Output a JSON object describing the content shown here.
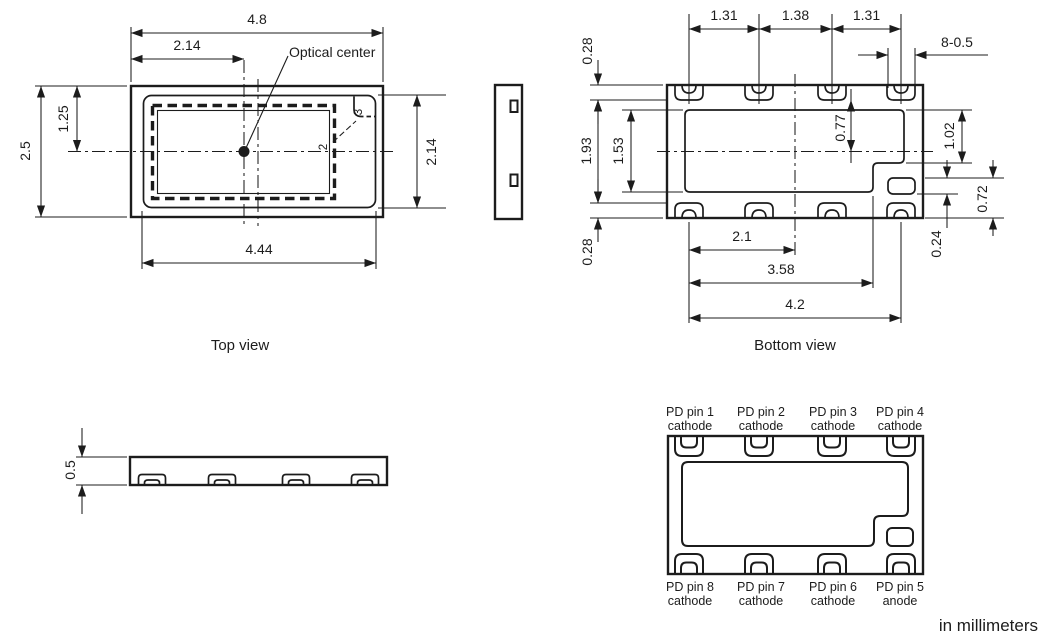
{
  "drawing": {
    "units_note": "in millimeters"
  },
  "top_view": {
    "label": "Top view",
    "optical_center_label": "Optical center",
    "dim_overall_width": "4.8",
    "dim_optical_center_x": "2.14",
    "dim_overall_height": "2.5",
    "dim_center_y": "1.25",
    "dim_inner_height": "2.14",
    "dim_inner_width": "4.44",
    "callout_2": "2",
    "callout_3": "3"
  },
  "bottom_view": {
    "label": "Bottom view",
    "dim_pad_pitch_left": "1.31",
    "dim_pad_pitch_center": "1.38",
    "dim_pad_pitch_right": "1.31",
    "dim_pad_width": "8-0.5",
    "dim_edge_to_pads_top": "0.28",
    "dim_pads_inner_span": "1.93",
    "dim_cavity_height": "1.53",
    "dim_edge_to_pads_bottom": "0.28",
    "dim_pad_to_centerline": "0.77",
    "dim_cavity_to_step": "1.02",
    "dim_anode_pad_to_edge": "0.72",
    "dim_anode_pad_height": "0.24",
    "dim_pad1_to_centerline": "2.1",
    "dim_pad1_to_step": "3.58",
    "dim_pads_span": "4.2"
  },
  "profile_view": {
    "dim_thickness": "0.5"
  },
  "pin_diagram": {
    "pins_top": [
      {
        "name": "PD pin 1",
        "terminal": "cathode"
      },
      {
        "name": "PD pin 2",
        "terminal": "cathode"
      },
      {
        "name": "PD pin 3",
        "terminal": "cathode"
      },
      {
        "name": "PD pin 4",
        "terminal": "cathode"
      }
    ],
    "pins_bottom": [
      {
        "name": "PD pin 8",
        "terminal": "cathode"
      },
      {
        "name": "PD pin 7",
        "terminal": "cathode"
      },
      {
        "name": "PD pin 6",
        "terminal": "cathode"
      },
      {
        "name": "PD pin 5",
        "terminal": "anode"
      }
    ]
  }
}
